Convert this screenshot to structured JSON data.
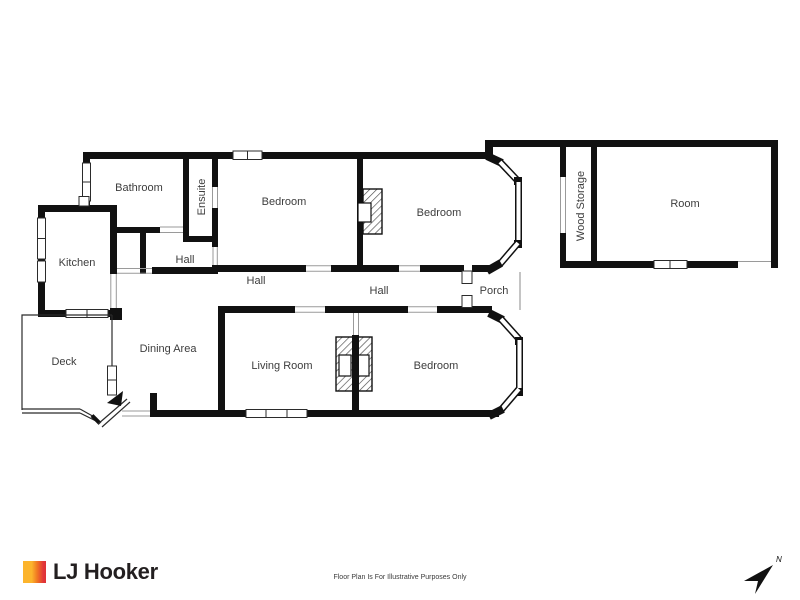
{
  "floor_plan": {
    "rooms": {
      "bathroom": "Bathroom",
      "ensuite": "Ensuite",
      "bedroom_left": "Bedroom",
      "bedroom_right": "Bedroom",
      "wood_storage": "Wood Storage",
      "room": "Room",
      "kitchen": "Kitchen",
      "hall_upper": "Hall",
      "hall_middle": "Hall",
      "hall_lower": "Hall",
      "porch": "Porch",
      "deck": "Deck",
      "dining_area": "Dining Area",
      "living_room": "Living Room",
      "bedroom_bottom": "Bedroom"
    }
  },
  "footer": {
    "brand": "LJ Hooker",
    "disclaimer": "Floor Plan Is For Illustrative Purposes Only",
    "compass_label": "N"
  },
  "colors": {
    "wall": "#111111",
    "room_label": "#3d3d3d",
    "window_outline": "#2b2b2b",
    "opening_line": "#9a9a9a",
    "logo_yellow": "#FCB42C",
    "logo_orange": "#F07622",
    "logo_red": "#E23739",
    "logo_text": "#231F20"
  }
}
